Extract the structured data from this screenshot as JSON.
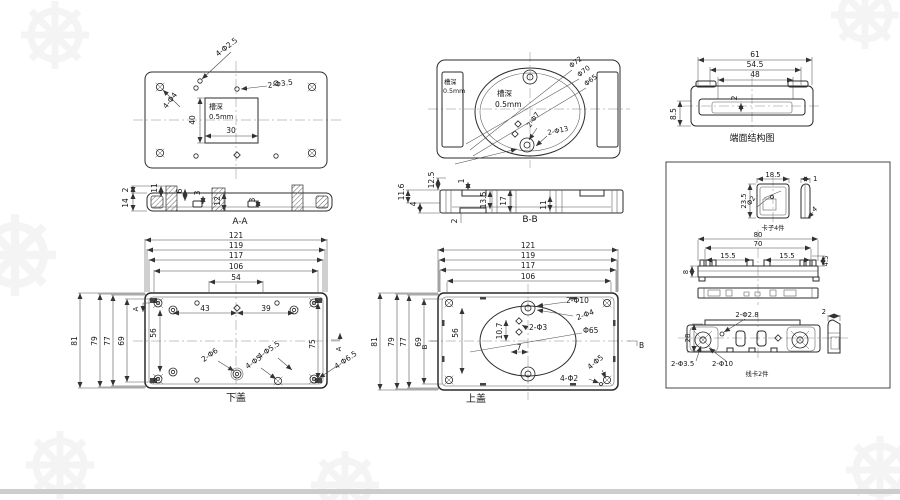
{
  "views": {
    "groove_plate": {
      "d40": "40",
      "d30": "30",
      "note_line1": "槽深",
      "note_line2": "0.5mm",
      "lbl_4x25": "4-Φ2.5",
      "lbl_4x4": "4-Φ4",
      "lbl_2x35": "2-Φ3.5"
    },
    "round_face": {
      "slot_note1": "槽深",
      "slot_note2": "0.5mm",
      "note_line1": "槽深",
      "note_line2": "0.5mm",
      "d72": "Φ72",
      "d70": "Φ70",
      "d65": "Φ65",
      "lbl_2x7": "2-Φ7",
      "lbl_2x13": "2-Φ13"
    },
    "end_face": {
      "caption": "端面结构图",
      "d61": "61",
      "d54_5": "54.5",
      "d48": "48",
      "d2": "2",
      "d8_5": "8.5"
    },
    "section_aa": {
      "caption": "A-A",
      "d2": "2",
      "d14": "14",
      "d11": "11",
      "d6": "6",
      "d3a": "3",
      "d12": "12",
      "d3b": "3"
    },
    "section_bb": {
      "caption": "B-B",
      "d12_5": "12.5",
      "d11_6": "11.6",
      "d4": "4",
      "d1": "1",
      "d13_5": "13.5",
      "d17": "17",
      "d11": "11",
      "d2": "2"
    },
    "bottom_cover": {
      "caption": "下盖",
      "top_dims": [
        "121",
        "119",
        "117",
        "106",
        "54"
      ],
      "left_dims": [
        "81",
        "79",
        "77",
        "69"
      ],
      "d43": "43",
      "d39": "39",
      "d56": "56",
      "d75": "75",
      "lbl_2x6": "2-Φ6",
      "lbl_4x5": "4-Φ5",
      "lbl_4x55": "4-Φ5.5",
      "lbl_4x65": "4-Φ6.5",
      "marker_a1": "A",
      "marker_a2": "A"
    },
    "top_cover": {
      "caption": "上盖",
      "top_dims": [
        "121",
        "119",
        "117",
        "106"
      ],
      "left_dims": [
        "81",
        "79",
        "77",
        "69"
      ],
      "d56": "56",
      "d10_7": "10.7",
      "d7": "7",
      "lbl_2x10": "2-Φ10",
      "lbl_2x4": "2-Φ4",
      "lbl_2x3": "2-Φ3",
      "lbl_x65": "Φ65",
      "lbl_4x5": "4-Φ5",
      "lbl_4x2": "4-Φ2",
      "marker_b1": "B",
      "marker_b2": "B"
    },
    "clip": {
      "caption": "卡子4件",
      "d18_5": "18.5",
      "d23_5": "23.5",
      "d_phi2": "Φ2",
      "d1": "1",
      "d4": "4"
    },
    "rail": {
      "d80": "80",
      "d70": "70",
      "d15_5a": "15.5",
      "d15_5b": "15.5",
      "d8": "8",
      "d4_5": "4.5"
    },
    "wire_clip": {
      "caption": "线卡2件",
      "d28": "28",
      "lbl_2x28": "2-Φ2.8",
      "d2": "2",
      "lbl_2x35": "2-Φ3.5",
      "lbl_2x10": "2-Φ10"
    }
  }
}
